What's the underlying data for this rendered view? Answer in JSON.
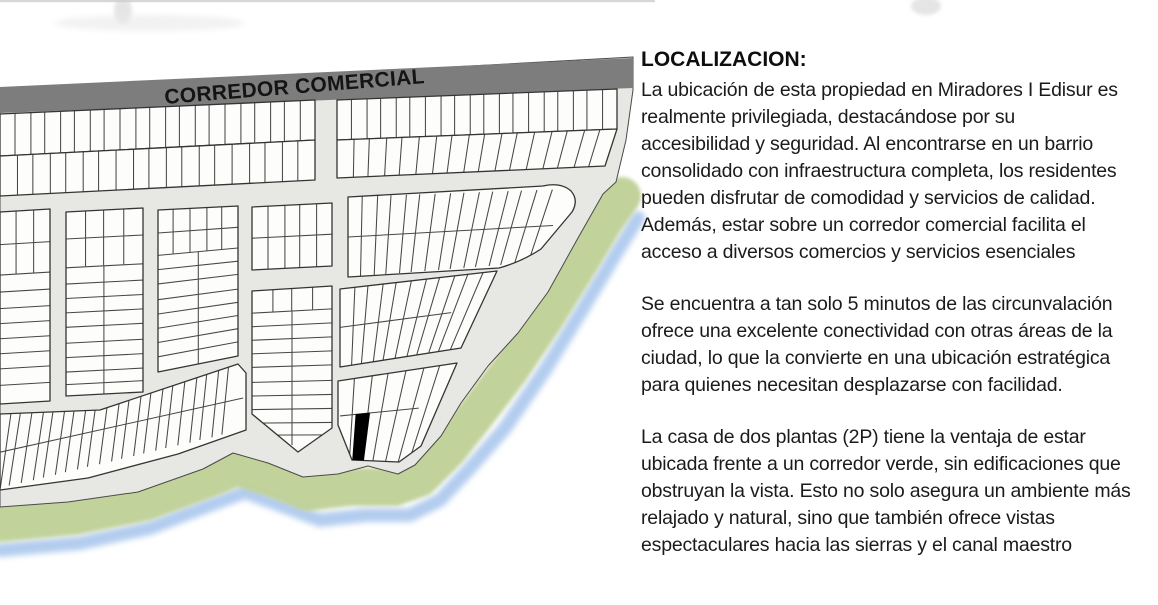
{
  "map": {
    "corridor_label": "CORREDOR COMERCIAL",
    "colors": {
      "road": "#7d7d7d",
      "street": "#e7e7e3",
      "lot_fill": "#fdfdfc",
      "lot_stroke": "#343434",
      "green_corridor": "#bfd096",
      "canal": "#a6c4ec",
      "highlight_lot": "#000000"
    }
  },
  "panel": {
    "title": "LOCALIZACION:",
    "paragraphs": [
      "La ubicación de esta propiedad en Miradores I Edisur es\nrealmente privilegiada, destacándose por su\naccesibilidad y seguridad. Al encontrarse en un barrio\nconsolidado con infraestructura completa, los residentes\npueden disfrutar de comodidad y servicios de calidad.\nAdemás, estar sobre un corredor comercial facilita el\nacceso a diversos comercios y servicios esenciales",
      "Se encuentra a tan solo 5 minutos de las circunvalación\nofrece una excelente conectividad con otras áreas de la\nciudad, lo que la convierte en una ubicación estratégica\npara quienes necesitan desplazarse con facilidad.",
      "La casa de dos plantas (2P) tiene la ventaja de estar\nubicada frente a un corredor verde, sin edificaciones que\nobstruyan la vista. Esto no solo asegura un ambiente más\nrelajado y natural, sino que también ofrece vistas\nespectaculares hacia las sierras y el canal maestro"
    ]
  }
}
